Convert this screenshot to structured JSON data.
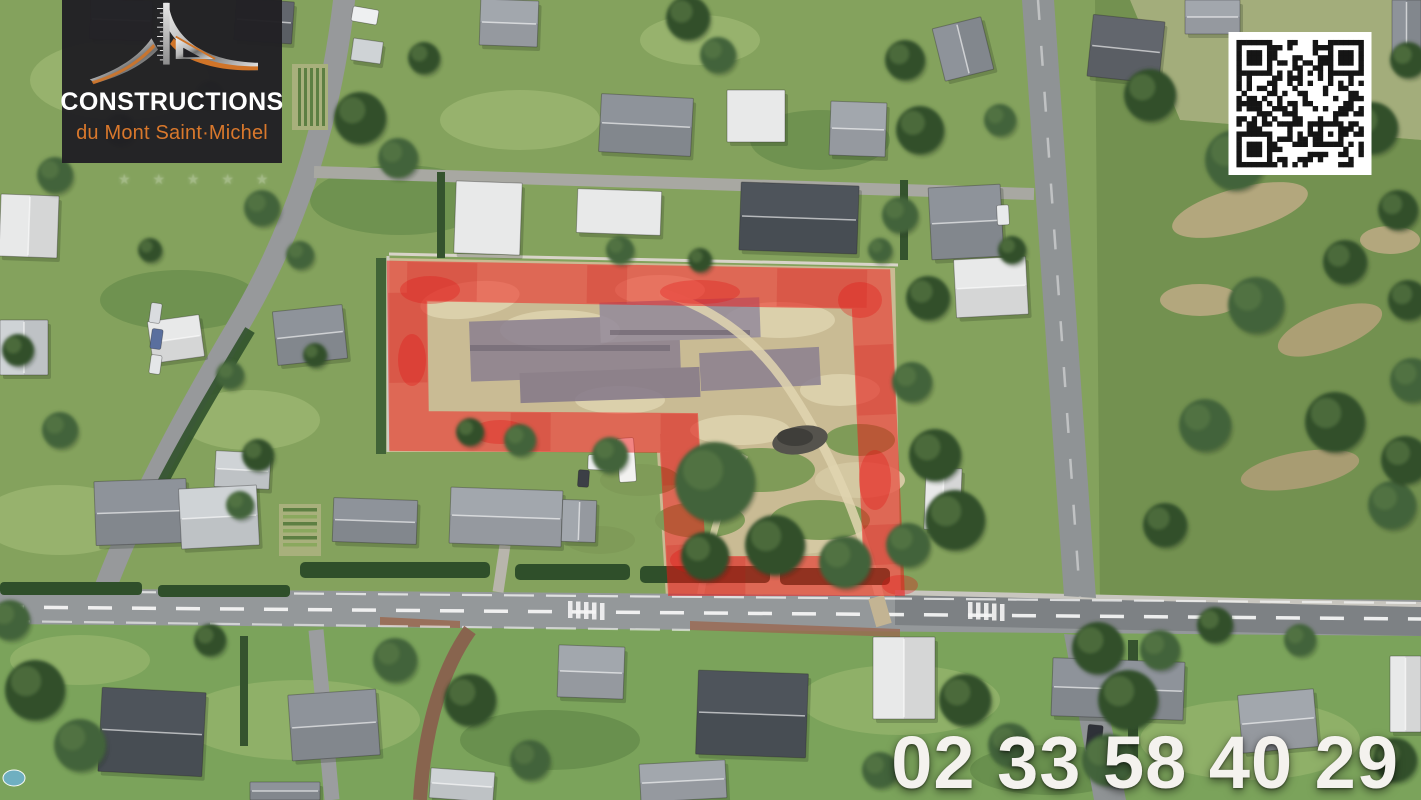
{
  "page": {
    "type": "aerial-land-listing-photo",
    "width_px": 1421,
    "height_px": 800
  },
  "branding": {
    "logo_title": "CONSTRUCTIONS",
    "logo_subtitle": "du Mont Saint·Michel",
    "logo_bg_color": "#212024",
    "logo_title_color": "#ffffff",
    "logo_subtitle_color": "#d9782c",
    "logo_icon": "arch-and-ruler-icon"
  },
  "watermark": {
    "stars": "★ ★ ★ ★ ★"
  },
  "contact": {
    "phone_number": "02 33 58 40 29",
    "color": "#f4f2ee"
  },
  "qr_code": {
    "name": "qr-code",
    "foreground": "#151515",
    "background": "#ffffff"
  },
  "plot_overlay": {
    "name": "plot-boundary-highlight",
    "color": "#f31616",
    "opacity": 0.5
  }
}
